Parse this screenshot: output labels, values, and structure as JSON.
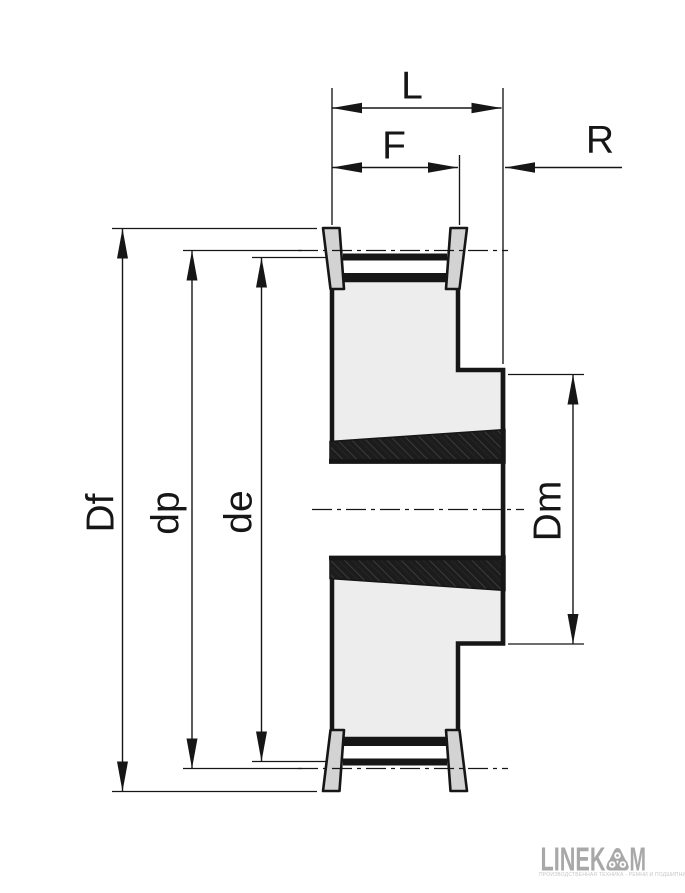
{
  "dims": {
    "overall_width": "L",
    "belt_width": "F",
    "hub_recess": "R",
    "flange_diameter": "Df",
    "pitch_diameter": "dp",
    "outside_diameter": "de",
    "hub_diameter": "Dm"
  },
  "logo": {
    "brand_left": "LINEK",
    "brand_right": "M",
    "icon": "pulley-rollers-icon",
    "tagline": "ПРОИЗВОДСТВЕННАЯ ТЕХНИКА - РЕМНИ И ПОДШИПНИКИ"
  },
  "colors": {
    "background": "#ffffff",
    "line": "#161616",
    "body_fill": "#ededed",
    "flange_fill": "#d3d3d3",
    "hatch_base": "#1c1c1c",
    "hatch_speck": "#3b3b3b",
    "logo_gray": "#a8a8a8",
    "tagline_gray": "#c5c5c5"
  }
}
